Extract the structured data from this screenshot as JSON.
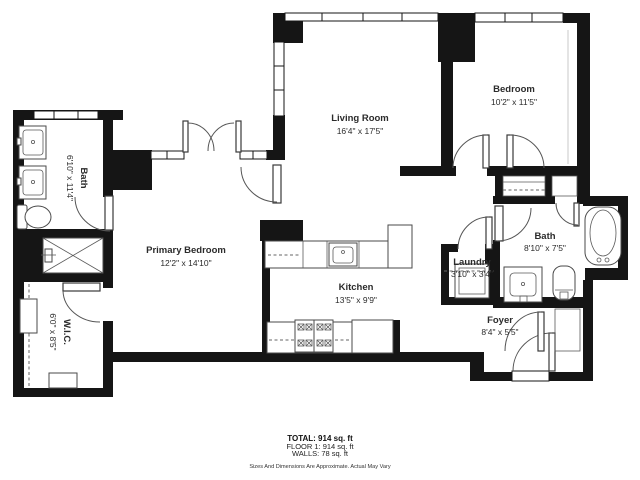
{
  "plan": {
    "wall_color": "#151515",
    "background_color": "#ffffff",
    "rooms": [
      {
        "name": "Living Room",
        "dims": "16'4\" x 17'5\""
      },
      {
        "name": "Bedroom",
        "dims": "10'2\" x 11'5\""
      },
      {
        "name": "Primary Bedroom",
        "dims": "12'2\" x 14'10\""
      },
      {
        "name": "Kitchen",
        "dims": "13'5\" x 9'9\""
      },
      {
        "name": "Bath",
        "dims": "6'10\" x 11'4\""
      },
      {
        "name": "W.I.C.",
        "dims": "6'0\" x 8'5\""
      },
      {
        "name": "Bath",
        "dims": "8'10\" x 7'5\""
      },
      {
        "name": "Laundry",
        "dims": "3'10\" x 3'4\""
      },
      {
        "name": "Foyer",
        "dims": "8'4\" x 5'5\""
      }
    ],
    "footer": {
      "total": "TOTAL: 914 sq. ft",
      "floor": "FLOOR 1: 914 sq. ft",
      "walls": "WALLS: 78 sq. ft",
      "disclaimer": "Sizes And Dimensions Are Approximate. Actual May Vary"
    }
  }
}
